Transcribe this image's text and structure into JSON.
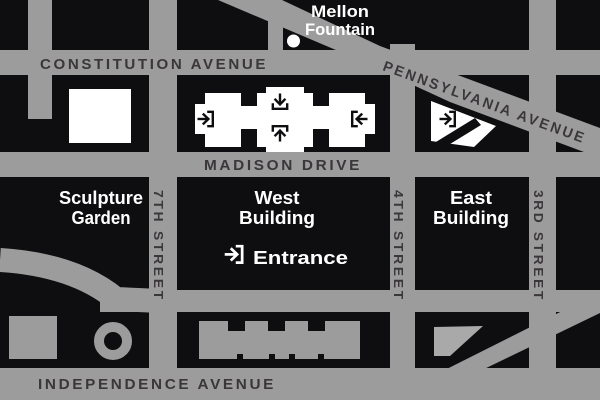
{
  "map": {
    "colors": {
      "street_gray": "#9c9c9c",
      "block_black": "#0e0e10",
      "street_label_dark": "#3a363a",
      "building_white": "#ffffff",
      "pond_gray": "#a9a9a9"
    },
    "streets": {
      "constitution": "CONSTITUTION AVENUE",
      "pennsylvania": "PENNSYLVANIA AVENUE",
      "madison": "MADISON DRIVE",
      "independence": "INDEPENDENCE AVENUE",
      "seventh": "7TH STREET",
      "fourth": "4TH STREET",
      "third": "3RD STREET"
    },
    "landmarks": {
      "mellon_fountain": {
        "line1": "Mellon",
        "line2": "Fountain"
      },
      "sculpture_garden": {
        "line1": "Sculpture",
        "line2": "Garden"
      },
      "west_building": {
        "line1": "West",
        "line2": "Building"
      },
      "east_building": {
        "line1": "East",
        "line2": "Building"
      },
      "entrance": "Entrance"
    }
  }
}
